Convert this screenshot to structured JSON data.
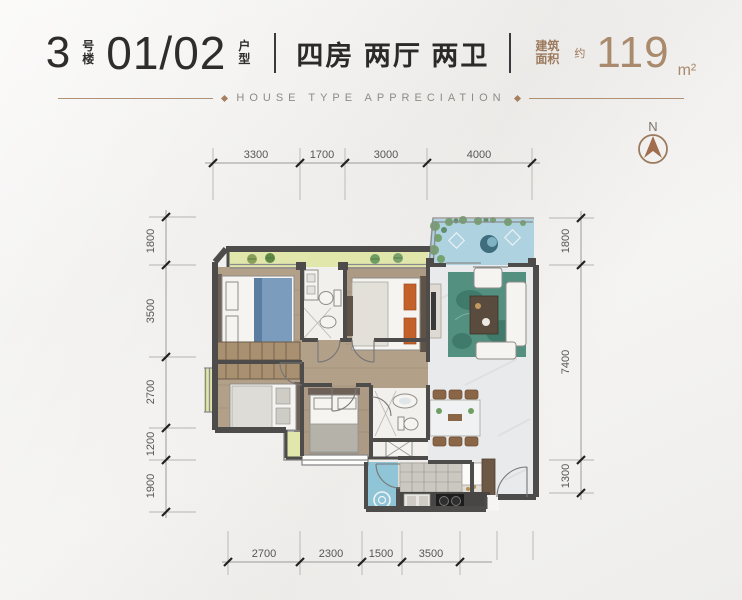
{
  "header": {
    "building_number": "3",
    "building_suffix_chars": [
      "号",
      "楼"
    ],
    "unit_number": "01/02",
    "unit_suffix_chars": [
      "户",
      "型"
    ],
    "layout_text": "四房 两厅 两卫",
    "area_label_chars": [
      "建筑",
      "面积"
    ],
    "area_approx_char": "约",
    "area_value": "119",
    "area_unit": "m²",
    "subtitle": "HOUSE TYPE APPRECIATION"
  },
  "compass": {
    "north_label": "N"
  },
  "floorplan": {
    "dimensions_mm": {
      "top": [
        "3300",
        "1700",
        "3000",
        "4000"
      ],
      "left": [
        "1800",
        "3500",
        "2700",
        "1200",
        "1900"
      ],
      "right": [
        "1800",
        "7400",
        "1300"
      ],
      "bottom": [
        "2700",
        "2300",
        "1500",
        "3500"
      ]
    }
  },
  "colors": {
    "accent_brown": "#9c7a5e",
    "title_dark": "#2e2d2b",
    "wall": "#4e4c4a",
    "balcony_green": "#e1e6ab",
    "water_blue": "#aed2df",
    "wood_floor": "#b2a089",
    "marble_floor": "#e9eaeb",
    "rug_teal": "#54907f",
    "laundry_blue": "#8fc5d6"
  }
}
